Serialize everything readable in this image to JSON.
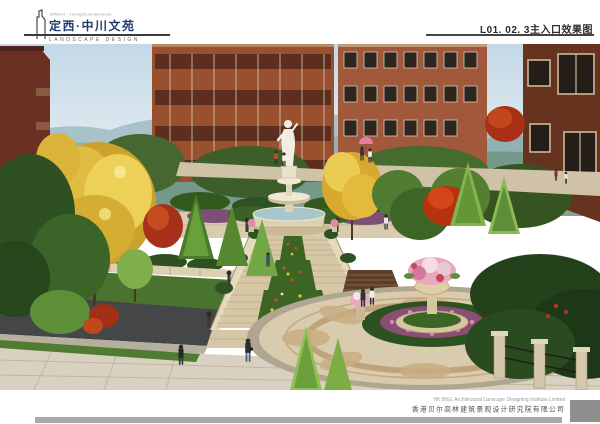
{
  "header": {
    "logo": {
      "tagline": "DINGXI - zhongchuanwenyuan",
      "title_cn": "定西·中川文苑",
      "subtitle_en": "LANDSCAPE DESIGN"
    },
    "sheet_title": "L01. 02. 3主入口效果图"
  },
  "footer": {
    "company_en": "HK BIGL Architectural Lanscape Designing Institute Limited",
    "company_cn": "香港贝尔高林建筑景观设计研究院有限公司"
  },
  "colors": {
    "logo_navy": "#233a6c",
    "rule_dark": "#3a3a3a",
    "footer_bar_gray": "#a9a9a9",
    "footer_block_gray": "#8f8f8f"
  }
}
